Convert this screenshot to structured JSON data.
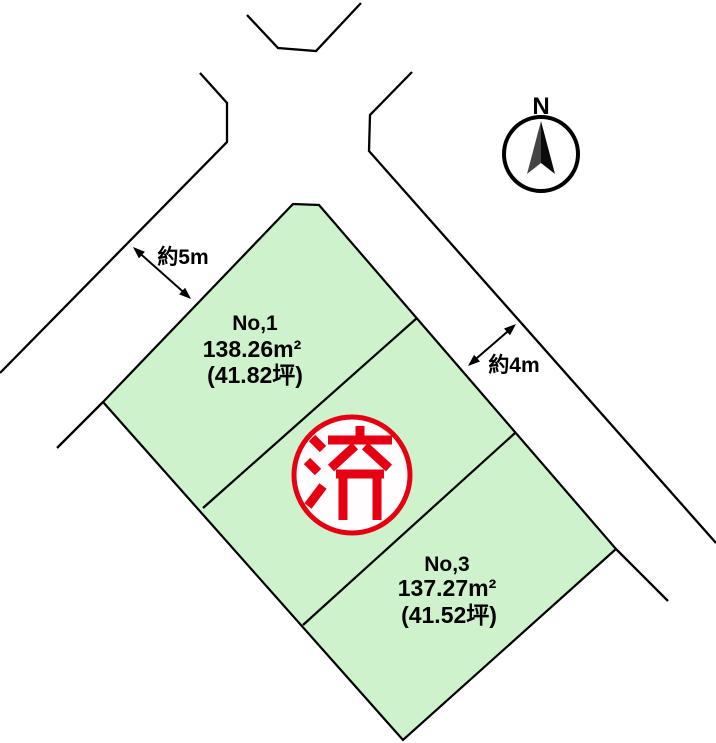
{
  "map": {
    "compass": {
      "label": "N"
    },
    "plots": {
      "no1": {
        "name": "No,1",
        "area": "138.26m²",
        "tsubo": "(41.82坪)"
      },
      "no2": {
        "stamp": "済"
      },
      "no3": {
        "name": "No,3",
        "area": "137.27m²",
        "tsubo": "(41.52坪)"
      }
    },
    "dimensions": {
      "west_road_width": "約5m",
      "east_road_width": "約4m"
    },
    "colors": {
      "parcel_fill": "#cdf2cc",
      "stamp_red": "#e60012",
      "line_black": "#000000"
    }
  }
}
